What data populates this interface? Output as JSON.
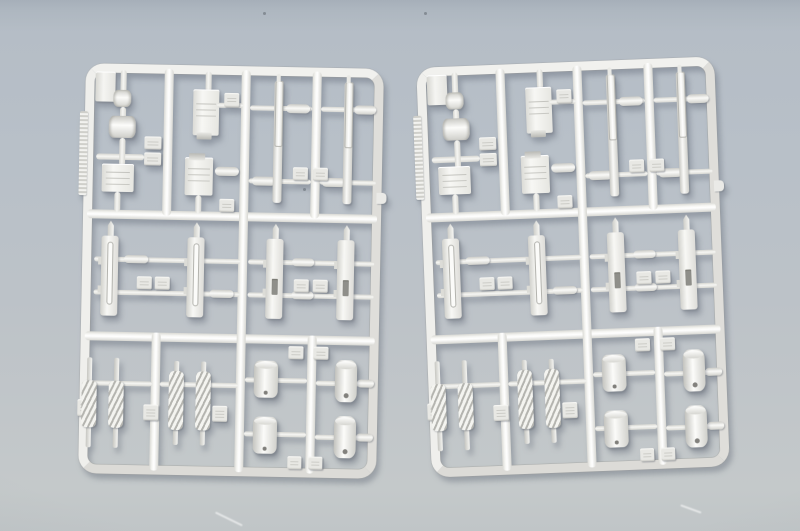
{
  "scene": {
    "description": "Photograph of two identical silver-gray plastic model kit sprues (injection-molded part frames) lying side by side on a blue-gray surface",
    "object_count": 2
  },
  "colors": {
    "surface_top": "#a6afb9",
    "surface_main": "#b8c0c8",
    "surface_bottom": "#c4c9ca",
    "plastic_light": "#ffffff",
    "plastic_base": "#ececе9",
    "plastic_shadow": "#c8c8c3",
    "slot_dark": "#8f8f8a"
  },
  "sprues": [
    {
      "name": "sprue-left",
      "x": 82,
      "y": 66,
      "rotate": 1.1
    },
    {
      "name": "sprue-right",
      "x": 424,
      "y": 62,
      "rotate": -2.2
    }
  ],
  "sprue_template": {
    "frame": {
      "w": 298,
      "h": 410,
      "thickness": 9,
      "radius": 18
    },
    "runners": [
      {
        "t": "h",
        "x": 4,
        "y": 146,
        "len": 290
      },
      {
        "t": "h",
        "x": 4,
        "y": 268,
        "len": 290
      },
      {
        "t": "v",
        "x": 156,
        "y": 4,
        "len": 402
      },
      {
        "t": "v",
        "x": 79,
        "y": 4,
        "len": 147
      },
      {
        "t": "v",
        "x": 227,
        "y": 4,
        "len": 147
      },
      {
        "t": "v",
        "x": 71,
        "y": 268,
        "len": 138
      },
      {
        "t": "v",
        "x": 227,
        "y": 268,
        "len": 138
      }
    ],
    "parts": [
      {
        "n": "corner-block",
        "t": "block",
        "x": 10,
        "y": 8,
        "w": 20,
        "h": 30
      },
      {
        "n": "serrated-strip",
        "t": "strip",
        "x": -5,
        "y": 48,
        "w": 8,
        "h": 84
      },
      {
        "n": "gate-bar",
        "t": "barv",
        "x": 35,
        "y": 6,
        "w": 6,
        "h": 24
      },
      {
        "n": "roller-knob",
        "t": "knob",
        "x": 28,
        "y": 26,
        "w": 18,
        "h": 17
      },
      {
        "n": "gate-bar",
        "t": "barv",
        "x": 35,
        "y": 43,
        "w": 6,
        "h": 12
      },
      {
        "n": "roller-cylinder",
        "t": "cylh",
        "x": 24,
        "y": 52,
        "w": 27,
        "h": 22
      },
      {
        "n": "gate-bar",
        "t": "barh",
        "x": 12,
        "y": 90,
        "w": 48,
        "h": 6
      },
      {
        "n": "gate-bar",
        "t": "barv",
        "x": 35,
        "y": 74,
        "w": 6,
        "h": 28
      },
      {
        "n": "part-number-tab",
        "t": "tab",
        "x": 60,
        "y": 72,
        "w": 17,
        "h": 13
      },
      {
        "n": "part-number-tab",
        "t": "tab",
        "x": 60,
        "y": 88,
        "w": 17,
        "h": 13
      },
      {
        "n": "equipment-box",
        "t": "box",
        "x": 18,
        "y": 100,
        "w": 32,
        "h": 28
      },
      {
        "n": "gate-bar",
        "t": "barv",
        "x": 31,
        "y": 128,
        "w": 6,
        "h": 20
      },
      {
        "n": "gate-bar",
        "t": "barv",
        "x": 120,
        "y": 6,
        "w": 6,
        "h": 20
      },
      {
        "n": "hull-box",
        "t": "box clip-bottom",
        "x": 108,
        "y": 24,
        "w": 26,
        "h": 46
      },
      {
        "n": "gate-bar",
        "t": "barh",
        "x": 132,
        "y": 37,
        "w": 26,
        "h": 5
      },
      {
        "n": "part-number-tab",
        "t": "tab",
        "x": 139,
        "y": 27,
        "w": 15,
        "h": 14
      },
      {
        "n": "hull-box",
        "t": "box clip-top",
        "x": 101,
        "y": 92,
        "w": 28,
        "h": 38
      },
      {
        "n": "connector-spindle",
        "t": "spindle",
        "x": 131,
        "y": 101,
        "w": 24,
        "h": 9
      },
      {
        "n": "gate-bar",
        "t": "barv",
        "x": 112,
        "y": 130,
        "w": 6,
        "h": 18
      },
      {
        "n": "part-number-tab",
        "t": "tab",
        "x": 136,
        "y": 133,
        "w": 15,
        "h": 13
      },
      {
        "n": "gate-bar",
        "t": "barh",
        "x": 165,
        "y": 39,
        "w": 62,
        "h": 5
      },
      {
        "n": "gate-bar",
        "t": "barh",
        "x": 236,
        "y": 39,
        "w": 56,
        "h": 5
      },
      {
        "n": "connector-spindle",
        "t": "spindle",
        "x": 201,
        "y": 37,
        "w": 24,
        "h": 9
      },
      {
        "n": "connector-spindle",
        "t": "spindle",
        "x": 269,
        "y": 37,
        "w": 22,
        "h": 9
      },
      {
        "n": "gate-bar",
        "t": "barh",
        "x": 165,
        "y": 112,
        "w": 62,
        "h": 5
      },
      {
        "n": "gate-bar",
        "t": "barh",
        "x": 236,
        "y": 112,
        "w": 56,
        "h": 5
      },
      {
        "n": "connector-spindle",
        "t": "spindle",
        "x": 168,
        "y": 110,
        "w": 24,
        "h": 9
      },
      {
        "n": "connector-spindle",
        "t": "spindle",
        "x": 238,
        "y": 110,
        "w": 24,
        "h": 9
      },
      {
        "n": "gun-barrel",
        "t": "rod",
        "x": 189,
        "y": 14,
        "w": 9,
        "h": 122
      },
      {
        "n": "gun-barrel",
        "t": "rod",
        "x": 259,
        "y": 14,
        "w": 9,
        "h": 122
      },
      {
        "n": "part-number-tab",
        "t": "tab",
        "x": 209,
        "y": 100,
        "w": 15,
        "h": 13
      },
      {
        "n": "part-number-tab",
        "t": "tab",
        "x": 229,
        "y": 100,
        "w": 15,
        "h": 13
      },
      {
        "n": "gate-bar",
        "t": "barh",
        "x": 12,
        "y": 193,
        "w": 146,
        "h": 5
      },
      {
        "n": "gate-bar",
        "t": "barh",
        "x": 12,
        "y": 226,
        "w": 146,
        "h": 5
      },
      {
        "n": "connector-spindle",
        "t": "spindle",
        "x": 42,
        "y": 191,
        "w": 24,
        "h": 8
      },
      {
        "n": "connector-spindle",
        "t": "spindle",
        "x": 128,
        "y": 224,
        "w": 24,
        "h": 8
      },
      {
        "n": "barrel-tip",
        "t": "tip",
        "x": 25,
        "y": 157,
        "w": 6,
        "h": 16
      },
      {
        "n": "gun-receiver",
        "t": "gun groove",
        "x": 19,
        "y": 172,
        "w": 17,
        "h": 80
      },
      {
        "n": "barrel-tip",
        "t": "tip",
        "x": 111,
        "y": 157,
        "w": 6,
        "h": 16
      },
      {
        "n": "gun-receiver",
        "t": "gun groove",
        "x": 105,
        "y": 172,
        "w": 17,
        "h": 80
      },
      {
        "n": "part-number-tab",
        "t": "tab",
        "x": 55,
        "y": 212,
        "w": 15,
        "h": 13
      },
      {
        "n": "part-number-tab",
        "t": "tab",
        "x": 73,
        "y": 212,
        "w": 15,
        "h": 13
      },
      {
        "n": "gate-bar",
        "t": "barh",
        "x": 166,
        "y": 193,
        "w": 126,
        "h": 5
      },
      {
        "n": "gate-bar",
        "t": "barh",
        "x": 166,
        "y": 226,
        "w": 126,
        "h": 5
      },
      {
        "n": "connector-spindle",
        "t": "spindle",
        "x": 210,
        "y": 191,
        "w": 22,
        "h": 8
      },
      {
        "n": "connector-spindle",
        "t": "spindle",
        "x": 210,
        "y": 224,
        "w": 22,
        "h": 8
      },
      {
        "n": "barrel-tip",
        "t": "tip",
        "x": 190,
        "y": 157,
        "w": 6,
        "h": 16
      },
      {
        "n": "gun-receiver",
        "t": "gun slot",
        "x": 184,
        "y": 172,
        "w": 17,
        "h": 80
      },
      {
        "n": "barrel-tip",
        "t": "tip",
        "x": 261,
        "y": 157,
        "w": 6,
        "h": 16
      },
      {
        "n": "gun-receiver",
        "t": "gun slot",
        "x": 255,
        "y": 172,
        "w": 17,
        "h": 80
      },
      {
        "n": "part-number-tab",
        "t": "tab",
        "x": 212,
        "y": 212,
        "w": 15,
        "h": 13
      },
      {
        "n": "part-number-tab",
        "t": "tab",
        "x": 231,
        "y": 212,
        "w": 15,
        "h": 13
      },
      {
        "n": "gate-bar",
        "t": "barh",
        "x": 6,
        "y": 317,
        "w": 66,
        "h": 5
      },
      {
        "n": "recoil-spring",
        "t": "coil",
        "x": 2,
        "y": 294,
        "w": 15,
        "h": 90
      },
      {
        "n": "recoil-spring",
        "t": "coil",
        "x": 29,
        "y": 294,
        "w": 15,
        "h": 90
      },
      {
        "n": "part-number-tab",
        "t": "tab",
        "x": -2,
        "y": 336,
        "w": 16,
        "h": 17
      },
      {
        "n": "gate-bar",
        "t": "barh",
        "x": 80,
        "y": 317,
        "w": 78,
        "h": 5
      },
      {
        "n": "recoil-spring",
        "t": "coil full",
        "x": 89,
        "y": 296,
        "w": 15,
        "h": 84
      },
      {
        "n": "recoil-spring",
        "t": "coil full",
        "x": 116,
        "y": 296,
        "w": 15,
        "h": 84
      },
      {
        "n": "part-number-tab",
        "t": "tab",
        "x": 64,
        "y": 340,
        "w": 15,
        "h": 16
      },
      {
        "n": "part-number-tab",
        "t": "tab",
        "x": 133,
        "y": 340,
        "w": 15,
        "h": 16
      },
      {
        "n": "part-number-tab",
        "t": "tab",
        "x": 208,
        "y": 279,
        "w": 15,
        "h": 13
      },
      {
        "n": "part-number-tab",
        "t": "tab",
        "x": 233,
        "y": 279,
        "w": 15,
        "h": 13
      },
      {
        "n": "gate-bar",
        "t": "barh",
        "x": 165,
        "y": 311,
        "w": 62,
        "h": 5
      },
      {
        "n": "gate-bar",
        "t": "barh",
        "x": 165,
        "y": 365,
        "w": 62,
        "h": 5
      },
      {
        "n": "ammo-canister",
        "t": "canister",
        "x": 174,
        "y": 294,
        "w": 24,
        "h": 37
      },
      {
        "n": "ammo-canister",
        "t": "canister",
        "x": 174,
        "y": 350,
        "w": 24,
        "h": 37
      },
      {
        "n": "gate-bar",
        "t": "barh",
        "x": 236,
        "y": 313,
        "w": 58,
        "h": 5
      },
      {
        "n": "gate-bar",
        "t": "barh",
        "x": 236,
        "y": 367,
        "w": 58,
        "h": 5
      },
      {
        "n": "connector-spindle",
        "t": "spindle",
        "x": 277,
        "y": 311,
        "w": 17,
        "h": 8
      },
      {
        "n": "connector-spindle",
        "t": "spindle",
        "x": 277,
        "y": 365,
        "w": 17,
        "h": 8
      },
      {
        "n": "ammo-drum",
        "t": "drum",
        "x": 255,
        "y": 292,
        "w": 22,
        "h": 42
      },
      {
        "n": "ammo-drum",
        "t": "drum",
        "x": 255,
        "y": 348,
        "w": 22,
        "h": 42
      },
      {
        "n": "part-number-tab",
        "t": "tab",
        "x": 209,
        "y": 389,
        "w": 14,
        "h": 13
      },
      {
        "n": "part-number-tab",
        "t": "tab",
        "x": 230,
        "y": 389,
        "w": 14,
        "h": 13
      },
      {
        "n": "ejector-nub",
        "t": "nub",
        "x": 293,
        "y": 124,
        "w": 10,
        "h": 11
      }
    ]
  },
  "background": {
    "specks": [
      {
        "x": 303,
        "y": 188
      },
      {
        "x": 263,
        "y": 12
      },
      {
        "x": 424,
        "y": 12
      }
    ],
    "scratches": [
      {
        "x": 214,
        "y": 518,
        "len": 30,
        "angle": 26
      },
      {
        "x": 680,
        "y": 508,
        "len": 22,
        "angle": 20
      }
    ]
  }
}
